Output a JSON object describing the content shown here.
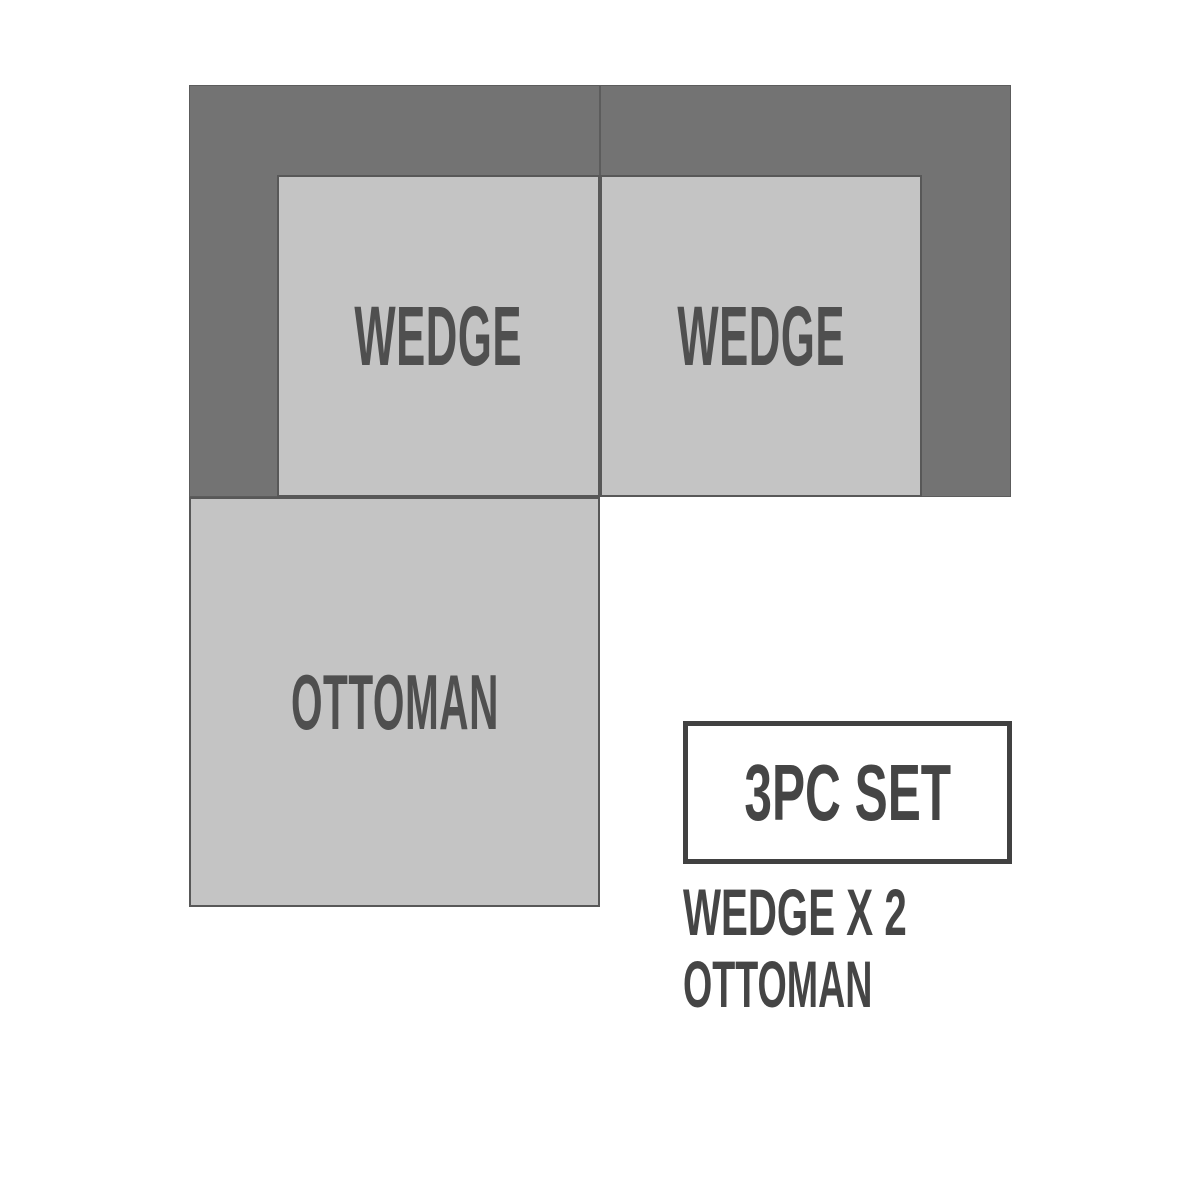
{
  "diagram": {
    "type": "sectional-sofa-floorplan",
    "pieces": [
      {
        "id": "wedge-left",
        "label": "WEDGE"
      },
      {
        "id": "wedge-right",
        "label": "WEDGE"
      },
      {
        "id": "ottoman",
        "label": "OTTOMAN"
      }
    ],
    "colors": {
      "frame_dark": "#737373",
      "seat_light": "#c4c4c4",
      "outline": "#585858",
      "label_text": "#4f4f4f",
      "legend_text": "#454545",
      "badge_border": "#414141",
      "background": "#ffffff"
    }
  },
  "legend": {
    "badge_label": "3PC SET",
    "lines": [
      {
        "text": "WEDGE X 2"
      },
      {
        "text": "OTTOMAN"
      }
    ]
  }
}
